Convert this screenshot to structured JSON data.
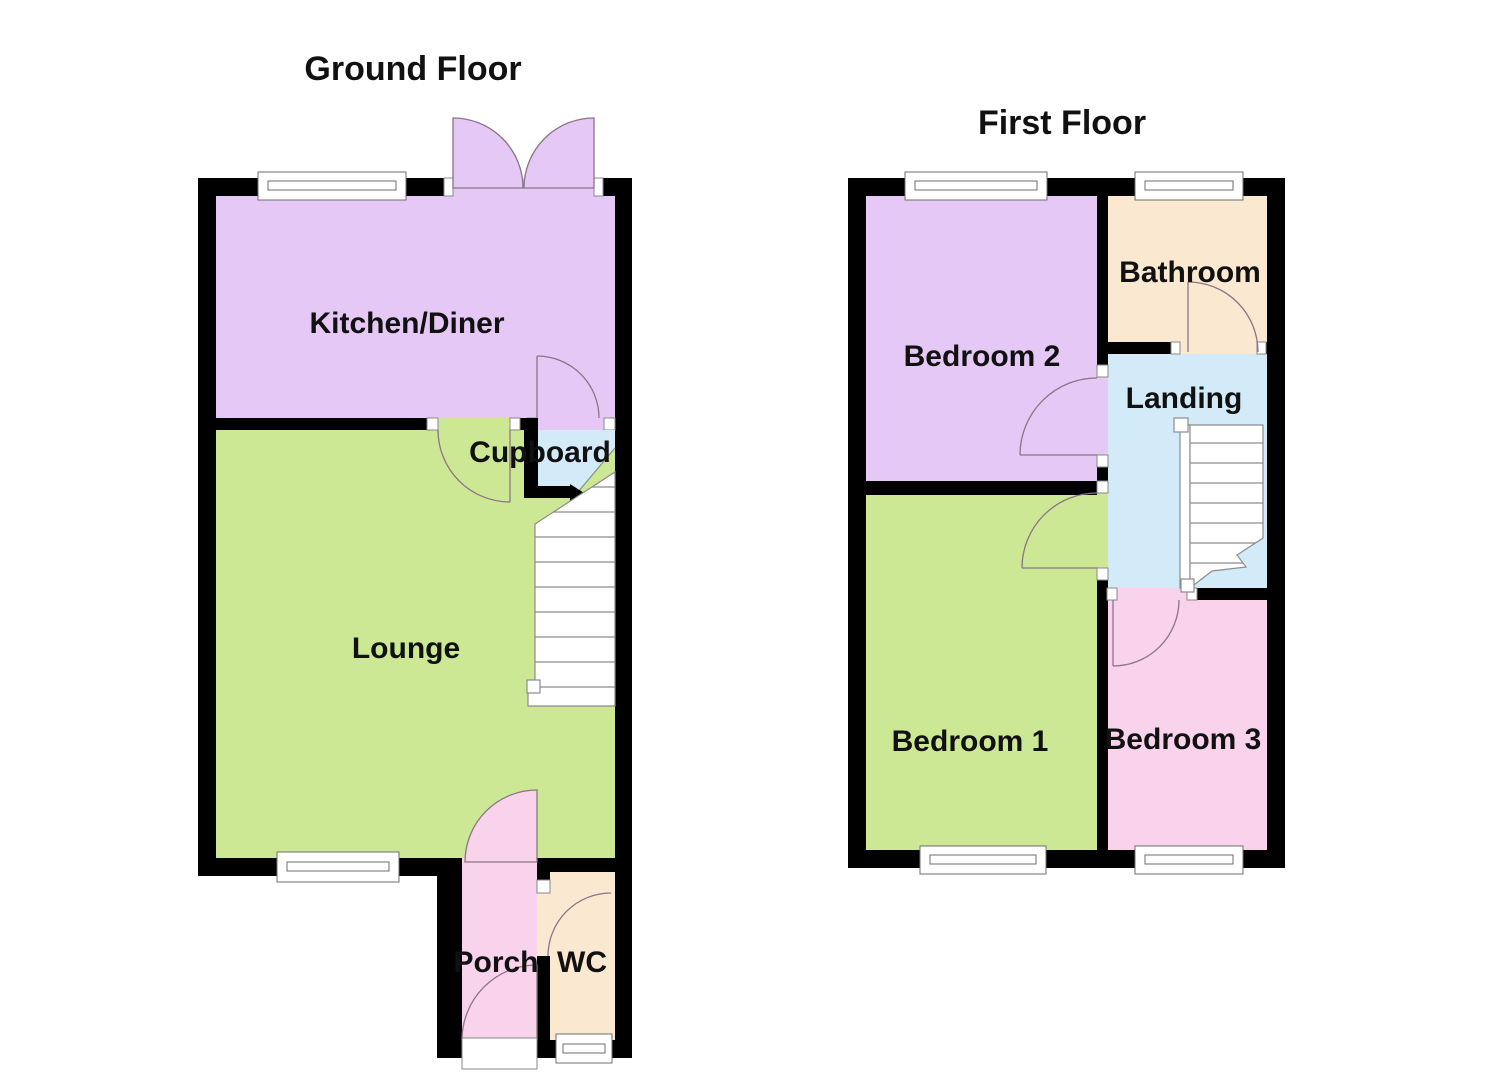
{
  "page": {
    "width": 1485,
    "height": 1080,
    "background": "#FFFFFF"
  },
  "colors": {
    "wall": "#000000",
    "kitchen_diner": "#E5C8F5",
    "lounge": "#CDE895",
    "cupboard": "#D3EAF9",
    "porch": "#F9D2EC",
    "wc": "#FAE8D0",
    "bedroom2": "#E5C8F5",
    "bedroom1": "#CDE895",
    "bedroom3": "#F9D2EC",
    "bathroom": "#FAE8D0",
    "landing": "#D3EAF9",
    "door_swing": "#8A7585",
    "stair_outline": "#8C8C8C",
    "window_outline": "#6E6E6E",
    "label_text": "#111111"
  },
  "ground_floor": {
    "title": "Ground Floor",
    "rooms": {
      "kitchen_diner": "Kitchen/Diner",
      "cupboard": "Cupboard",
      "lounge": "Lounge",
      "porch": "Porch",
      "wc": "WC"
    }
  },
  "first_floor": {
    "title": "First Floor",
    "rooms": {
      "bedroom2": "Bedroom 2",
      "bathroom": "Bathroom",
      "landing": "Landing",
      "bedroom1": "Bedroom 1",
      "bedroom3": "Bedroom 3"
    }
  }
}
